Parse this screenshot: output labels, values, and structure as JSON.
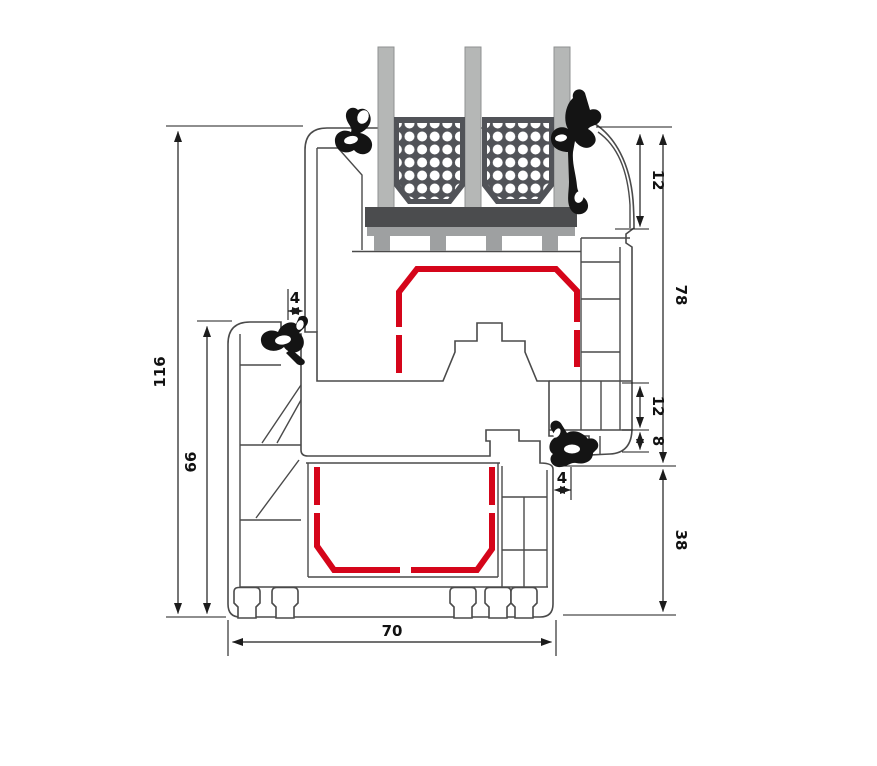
{
  "diagram": {
    "type": "technical-cross-section",
    "subject": "pvc-window-frame-and-sash-profile-with-triple-glazing",
    "units": "mm",
    "dims": {
      "total_height": "116",
      "frame_height_left": "66",
      "frame_width_bottom": "70",
      "sash_face_top": "12",
      "sash_height_right": "78",
      "sash_chamber_right": "12",
      "sash_ledge_right": "8",
      "seal_gap_top": "4",
      "seal_gap_bottom": "4",
      "frame_face_right": "38"
    },
    "colors": {
      "outline": "#4a4a4a",
      "dimension_line": "#1c1c1c",
      "steel_reinforcement_red": "#d5051a",
      "glass_pane_gray": "#b5b7b6",
      "spacer_dark": "#515358",
      "glazing_block_dark": "#4b4c4e",
      "glazing_block_light": "#9ea0a1",
      "gasket_black": "#141414",
      "background": "#ffffff"
    }
  }
}
